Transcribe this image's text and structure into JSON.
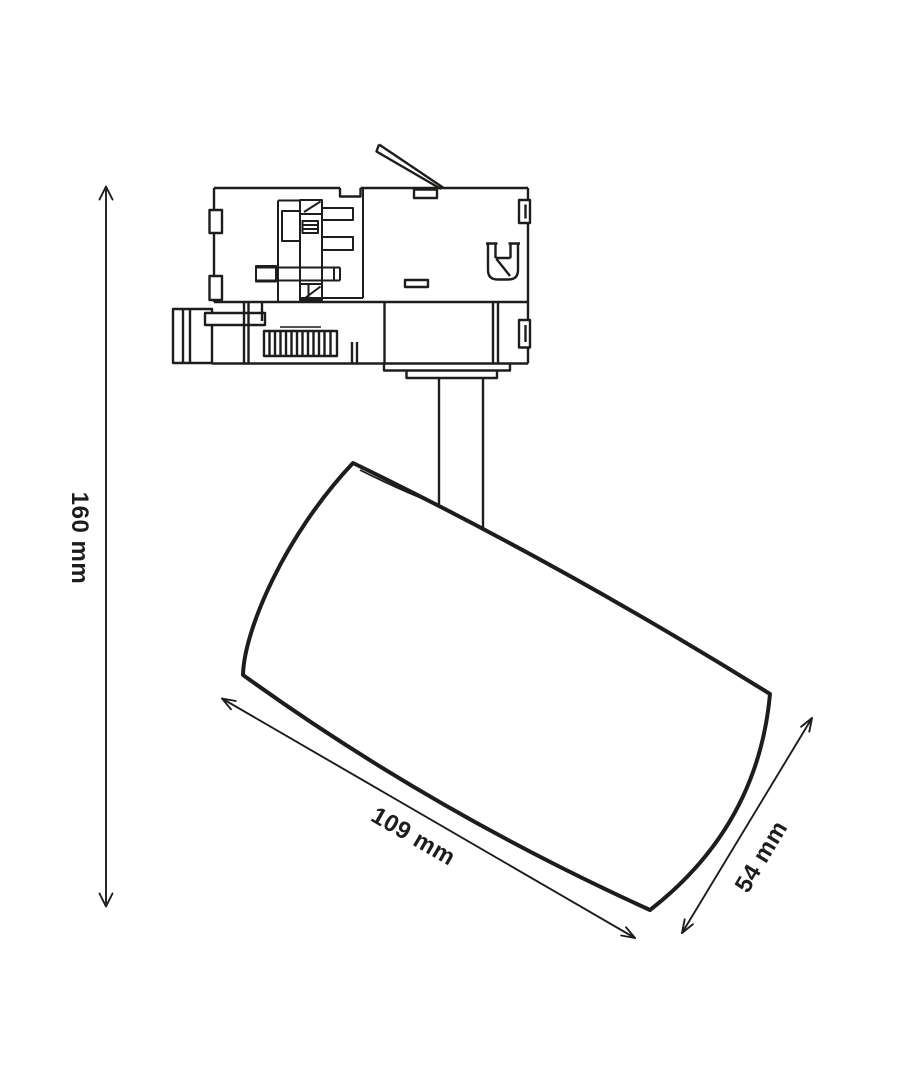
{
  "canvas": {
    "width": 910,
    "height": 1080,
    "background": "#ffffff",
    "line_color": "#1d1d1b",
    "content": "technical-dimension-drawing-of-track-spotlight"
  },
  "dimensions": {
    "height": {
      "label": "160 mm",
      "value": 160,
      "unit": "mm",
      "orientation": "vertical-left"
    },
    "length": {
      "label": "109 mm",
      "value": 109,
      "unit": "mm",
      "orientation": "diagonal-along-body"
    },
    "diameter": {
      "label": "54 mm",
      "value": 54,
      "unit": "mm",
      "orientation": "diagonal-across-front"
    }
  }
}
